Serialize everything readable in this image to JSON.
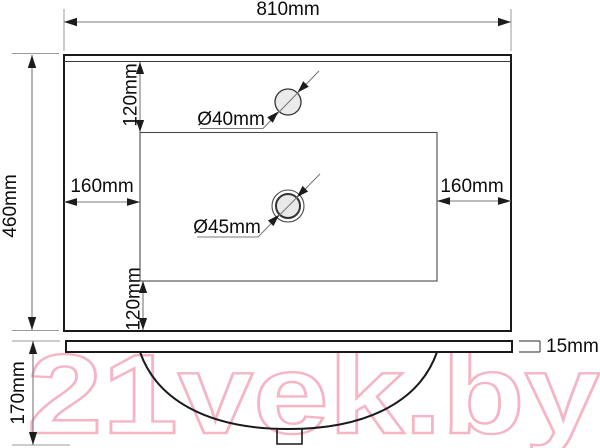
{
  "watermark": {
    "text": "21vek.by",
    "color": "#f5b5c5"
  },
  "labels": {
    "width_top": "810mm",
    "height_left": "460mm",
    "offset_top": "120mm",
    "offset_bottom": "120mm",
    "inset_left": "160mm",
    "inset_right": "160mm",
    "faucet_hole": "Ø40mm",
    "drain": "Ø45mm",
    "thickness": "15mm",
    "front_height": "170mm"
  },
  "colors": {
    "line": "#1a1a1a",
    "dimension_line": "#7a7a7a",
    "text": "#0d0d0d",
    "hole_fill": "#ebebeb",
    "watermark": "#f5b5c5"
  }
}
